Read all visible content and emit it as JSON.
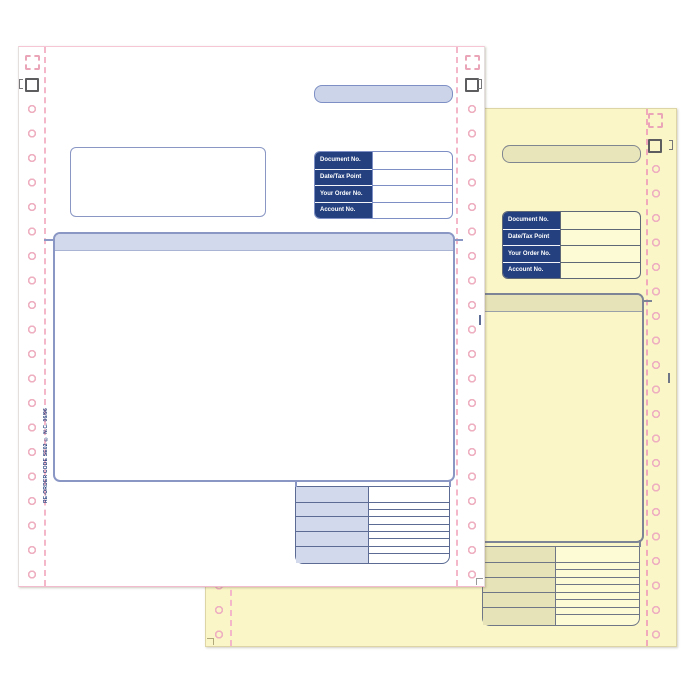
{
  "colors": {
    "navy_label": "#24407e",
    "lavender_fill": "#d3d9ec",
    "blue_border": "#8a97c4",
    "dark_line": "#5b6b94",
    "perforation_pink": "#f4b7ca",
    "white_paper": "#ffffff",
    "yellow_paper": "#fbf6c7",
    "khaki_fill": "#e7e3b8",
    "grey_border": "#6f7787"
  },
  "white_form": {
    "doc_table": {
      "rows": [
        {
          "label": "Document No."
        },
        {
          "label": "Date/Tax Point"
        },
        {
          "label": "Your Order No."
        },
        {
          "label": "Account No."
        }
      ]
    },
    "reorder_code": "RE-ORDER CODE SE02 © N.C. 06/96"
  },
  "yellow_form": {
    "doc_table": {
      "rows": [
        {
          "label": "Document No."
        },
        {
          "label": "Date/Tax Point"
        },
        {
          "label": "Your Order No."
        },
        {
          "label": "Account No."
        }
      ]
    }
  }
}
